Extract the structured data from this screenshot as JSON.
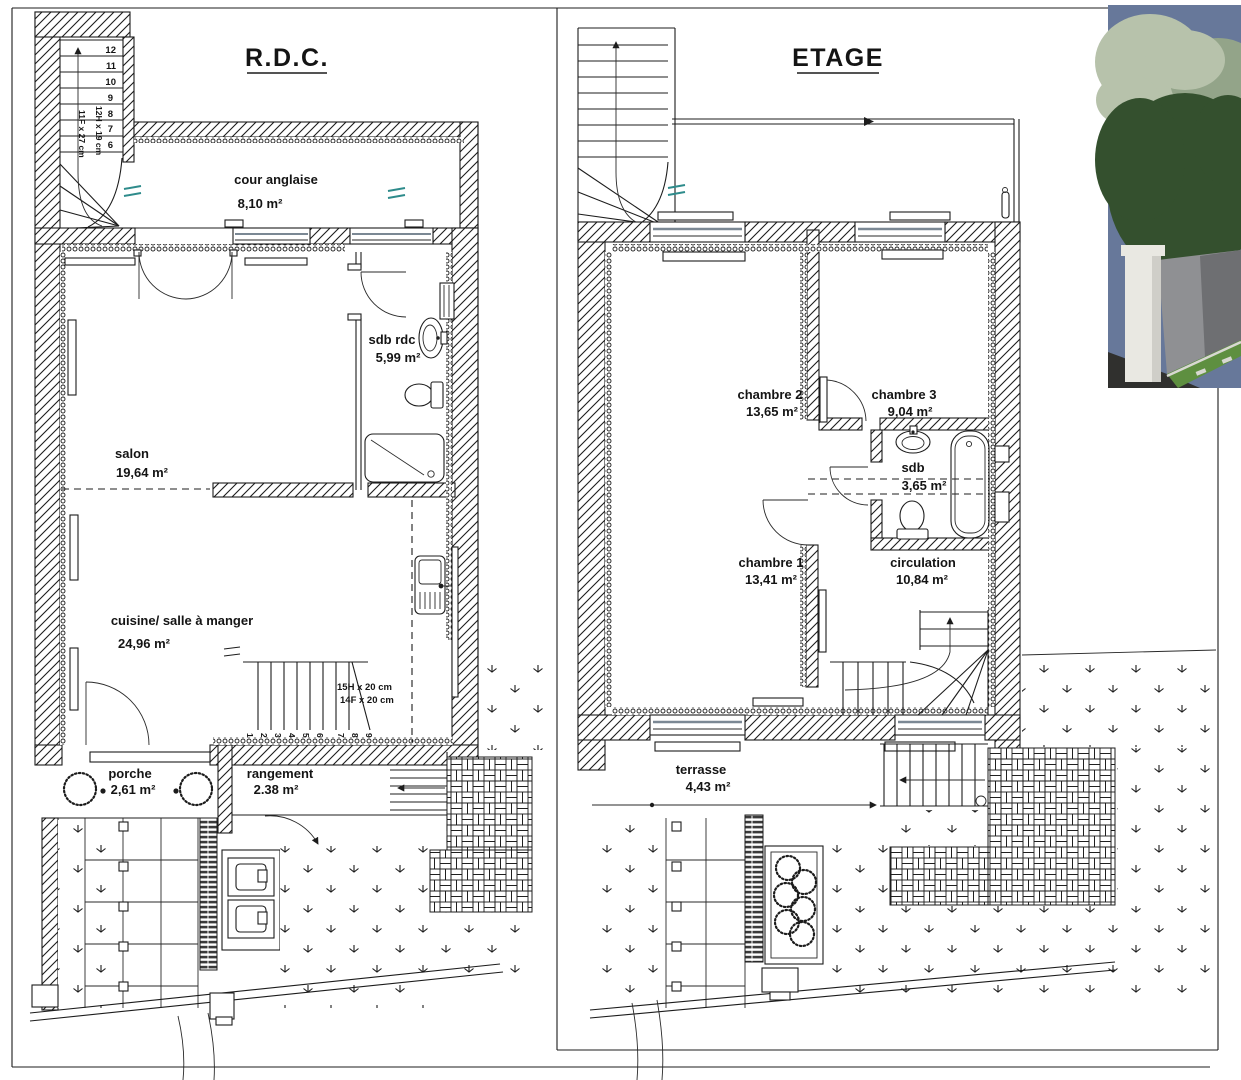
{
  "colors": {
    "ink": "#1c1c1c",
    "glazing": "#7b8894",
    "cut_mark": "#2e8b8b"
  },
  "plans": {
    "rdc": {
      "title": "R.D.C.",
      "rooms": {
        "cour_anglaise": {
          "name": "cour anglaise",
          "area": "8,10 m²"
        },
        "salon": {
          "name": "salon",
          "area": "19,64 m²"
        },
        "sdb_rdc": {
          "name": "sdb rdc",
          "area": "5,99 m²"
        },
        "cuisine": {
          "name": "cuisine/ salle à manger",
          "area": "24,96 m²"
        },
        "porche": {
          "name": "porche",
          "area": "2,61 m²"
        },
        "rangement": {
          "name": "rangement",
          "area": "2.38 m²"
        }
      },
      "main_stair": {
        "steps": [
          "12",
          "11",
          "10",
          "9",
          "8",
          "7",
          "6"
        ],
        "note1": "12H x 19 cm",
        "note2": "11F x 27 cm"
      },
      "kitchen_stair": {
        "steps": [
          "1",
          "2",
          "3",
          "4",
          "5",
          "6",
          "7",
          "8",
          "9"
        ],
        "note1": "15H x 20 cm",
        "note2": "14F x 20 cm"
      }
    },
    "etage": {
      "title": "ETAGE",
      "rooms": {
        "chambre2": {
          "name": "chambre 2",
          "area": "13,65 m²"
        },
        "chambre3": {
          "name": "chambre 3",
          "area": "9,04 m²"
        },
        "sdb": {
          "name": "sdb",
          "area": "3,65 m²"
        },
        "chambre1": {
          "name": "chambre 1",
          "area": "13,41 m²"
        },
        "circulation": {
          "name": "circulation",
          "area": "10,84 m²"
        },
        "terrasse": {
          "name": "terrasse",
          "area": "4,43 m²"
        }
      }
    }
  },
  "photo": {
    "colors": {
      "sky": "#67789a",
      "foliage_light": "#b7c2ab",
      "foliage_mid": "#93a489",
      "foliage_dark": "#34502e",
      "wall": "#8f9093",
      "wall_dark": "#6e6f72",
      "pillar": "#e9e8e2",
      "pillar_shade": "#cfcec8",
      "grass": "#5e8f40",
      "path": "#30302e",
      "curb": "#d8d8d2"
    }
  }
}
